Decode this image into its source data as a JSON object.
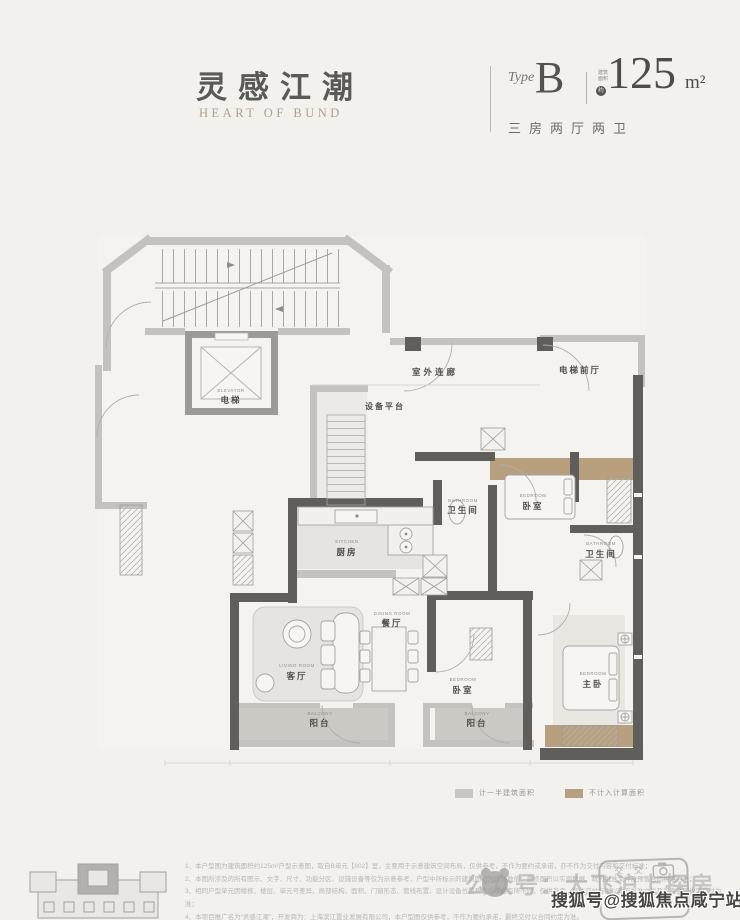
{
  "page": {
    "bg": "#f2f1ee"
  },
  "header": {
    "brand_cn": "灵感江潮",
    "brand_en": "HEART OF BUND",
    "type_label": "Type",
    "type_value": "B",
    "area_note_line1": "建筑",
    "area_note_line2": "面积",
    "area_note_circle": "约",
    "area_value": "125",
    "area_unit": "m²",
    "layout_desc": "三房两厅两卫"
  },
  "plan": {
    "rooms": {
      "elevator": {
        "en": "ELEVATOR",
        "cn": "电梯"
      },
      "outdoor_corridor": {
        "cn": "室外连廊"
      },
      "elevator_lobby": {
        "cn": "电梯前厅"
      },
      "equipment_platform": {
        "cn": "设备平台"
      },
      "bathroom1": {
        "en": "BATHROOM",
        "cn": "卫生间"
      },
      "bedroom1": {
        "en": "BEDROOM",
        "cn": "卧室"
      },
      "bathroom2": {
        "en": "BATHROOM",
        "cn": "卫生间"
      },
      "kitchen": {
        "en": "KITCHEN",
        "cn": "厨房"
      },
      "dining_room": {
        "en": "DINING ROOM",
        "cn": "餐厅"
      },
      "living_room": {
        "en": "LIVING ROOM",
        "cn": "客厅"
      },
      "bedroom2": {
        "en": "BEDROOM",
        "cn": "卧室"
      },
      "master_bedroom": {
        "en": "BEDROOM",
        "cn": "主卧"
      },
      "balcony1": {
        "en": "BALCONY",
        "cn": "阳台"
      },
      "balcony2": {
        "en": "BALCONY",
        "cn": "阳台"
      }
    }
  },
  "legend": {
    "half_area": {
      "color": "#c9c7c2",
      "label": "计一半建筑面积"
    },
    "excluded_area": {
      "color": "#b89f7d",
      "label": "不计入计算面积"
    }
  },
  "footer": {
    "disclaimer_lines": [
      "1、本户型图为建筑面积约125m²户型示意图，取自B单元【802】室，主要用于示意建筑空间布局，仅供参考，不作为要约或承诺，亦不作为交付内容和交付标准；",
      "2、本图所涉及的所有图示、文字、尺寸、功能分区、设施设备等仅为示意参考，户型中所标示的建筑面积为设计数值，最终面积以实测数据、政府批准文件及预售合同约定为准；",
      "3、相同户型单元因楼栋、楼层、单元号差异，局部结构、面积、门窗形态、管线布置、设计设备位置及大小等会有所不同，仅供参考，具体交付标准以政府批准文件及买卖合同约定交付为准；",
      "4、本项目推广名为“灵感江潮”，开发商为：上海滨江置业发展有限公司，本户型图仅供参考，不作为要约承诺，最终交付以合同约定为准。"
    ]
  },
  "watermarks": {
    "light_text": "公众号：大飞沪上探房",
    "dark_text": "搜狐号@搜狐焦点咸宁站",
    "badge_icons": "交 交"
  }
}
